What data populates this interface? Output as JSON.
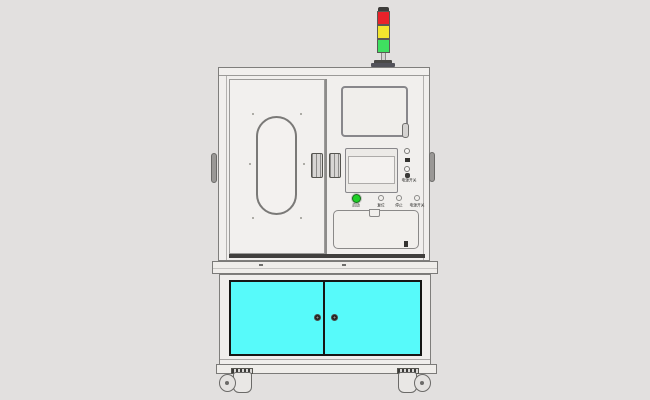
{
  "scene": {
    "background_color": "#e2e0df",
    "machine_body_color": "#f1efed",
    "outline_color": "#7f7e7c"
  },
  "tower_light": {
    "segments": [
      {
        "name": "red-lamp",
        "color": "#e9222a"
      },
      {
        "name": "yellow-lamp",
        "color": "#f2e52e"
      },
      {
        "name": "green-lamp",
        "color": "#3fdf60"
      }
    ]
  },
  "control_panel": {
    "power_switch_label": "电源开关",
    "buttons": [
      {
        "label": "启动",
        "color": "#1fcf27"
      },
      {
        "label": "复位",
        "color": "#f1efec"
      },
      {
        "label": "停止",
        "color": "#f1efec"
      },
      {
        "label": "电源开关",
        "color": "#f1efec"
      }
    ]
  },
  "lower_cabinet": {
    "door_color": "#57fafa",
    "frame_color": "#161614"
  }
}
